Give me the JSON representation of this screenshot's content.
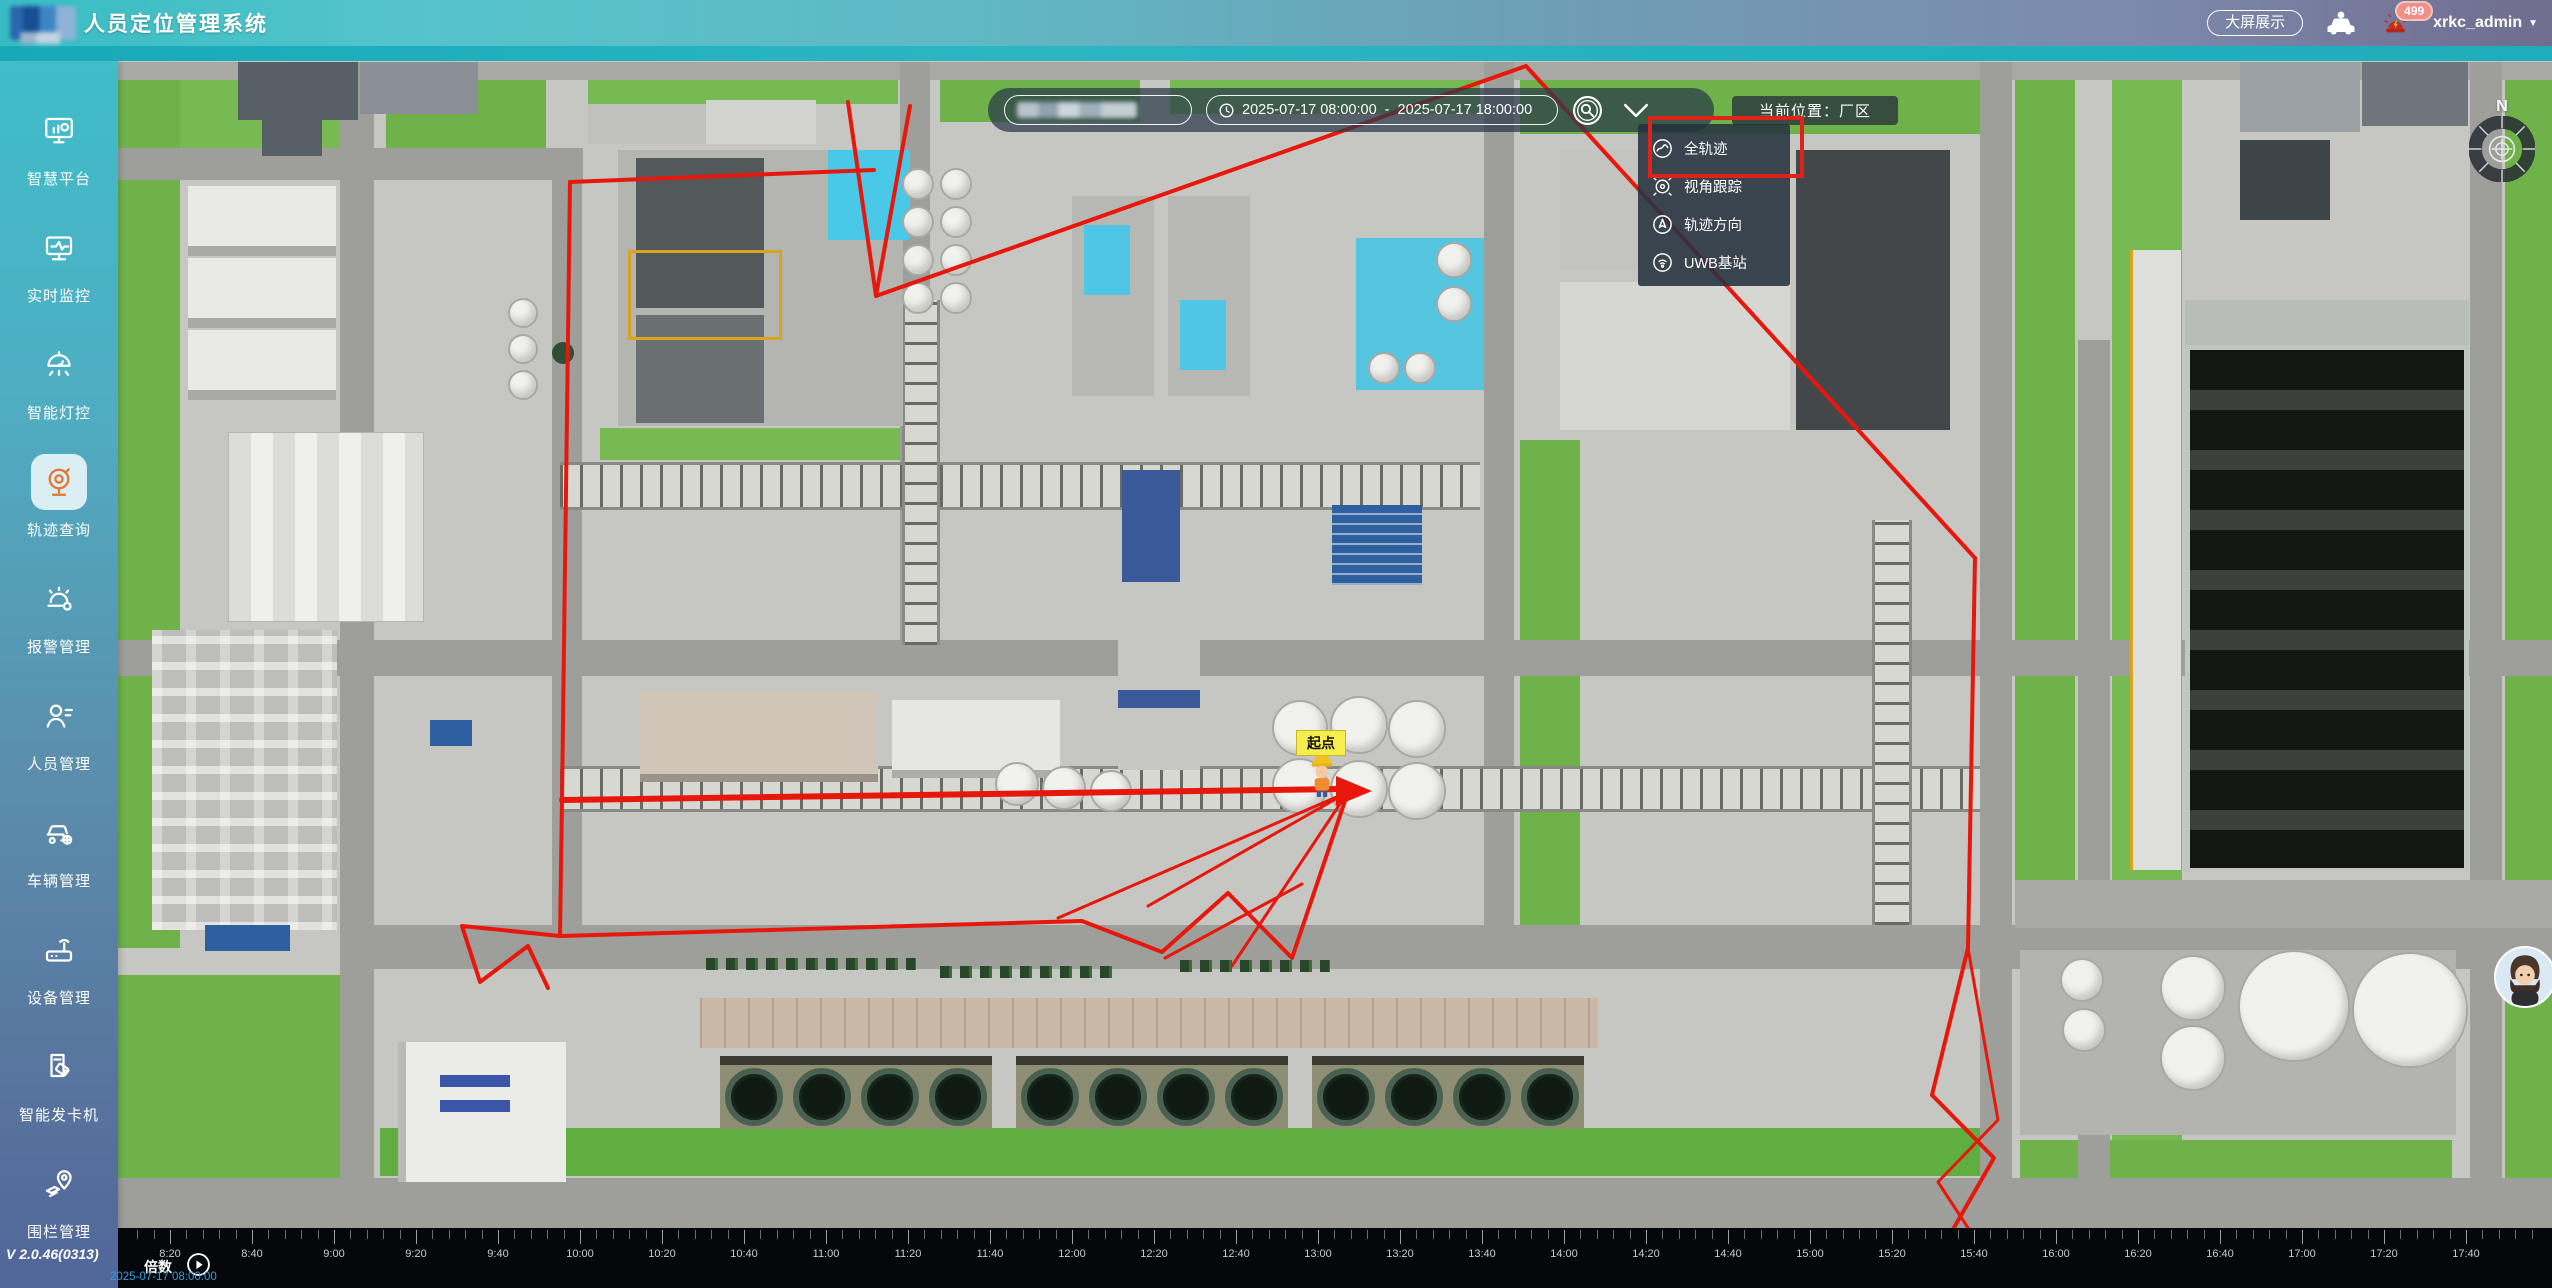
{
  "header": {
    "title": "人员定位管理系统",
    "big_screen": "大屏展示",
    "username": "xrkc_admin",
    "alarm_badge": "499"
  },
  "sidebar": {
    "version": "V 2.0.46(0313)",
    "items": [
      {
        "id": "smart-platform",
        "label": "智慧平台",
        "active": false
      },
      {
        "id": "realtime-monitor",
        "label": "实时监控",
        "active": false
      },
      {
        "id": "smart-light",
        "label": "智能灯控",
        "active": false
      },
      {
        "id": "track-query",
        "label": "轨迹查询",
        "active": true
      },
      {
        "id": "alarm-mgmt",
        "label": "报警管理",
        "active": false
      },
      {
        "id": "personnel-mgmt",
        "label": "人员管理",
        "active": false
      },
      {
        "id": "vehicle-mgmt",
        "label": "车辆管理",
        "active": false
      },
      {
        "id": "device-mgmt",
        "label": "设备管理",
        "active": false
      },
      {
        "id": "card-dispenser",
        "label": "智能发卡机",
        "active": false
      },
      {
        "id": "fence-mgmt",
        "label": "围栏管理",
        "active": false
      }
    ]
  },
  "toolbar": {
    "date_start": "2025-07-17 08:00:00",
    "separator": "-",
    "date_end": "2025-07-17 18:00:00",
    "location": "当前位置：厂区"
  },
  "dropdown": {
    "items": [
      {
        "id": "full-track",
        "label": "全轨迹",
        "highlighted": true
      },
      {
        "id": "view-follow",
        "label": "视角跟踪",
        "highlighted": false
      },
      {
        "id": "track-direction",
        "label": "轨迹方向",
        "highlighted": false
      },
      {
        "id": "uwb-station",
        "label": "UWB基站",
        "highlighted": false
      }
    ]
  },
  "map": {
    "start_marker": "起点",
    "compass_n": "N"
  },
  "timeline": {
    "speed_label": "倍数",
    "current_time": "2025-07-17 08:00:00",
    "start_x": 52,
    "spacing": 82,
    "labels": [
      "8:20",
      "8:40",
      "9:00",
      "9:20",
      "9:40",
      "10:00",
      "10:20",
      "10:40",
      "11:00",
      "11:20",
      "11:40",
      "12:00",
      "12:20",
      "12:40",
      "13:00",
      "13:20",
      "13:40",
      "14:00",
      "14:20",
      "14:40",
      "15:00",
      "15:20",
      "15:40",
      "16:00",
      "16:20",
      "16:40",
      "17:00",
      "17:20",
      "17:40"
    ]
  },
  "trajectory": {
    "color": "#e8170c",
    "arrow": [
      [
        1336,
        776
      ],
      [
        1372,
        791
      ],
      [
        1336,
        806
      ]
    ],
    "polylines": [
      {
        "w": 4,
        "points": [
          [
            848,
            102
          ],
          [
            876,
            296
          ],
          [
            910,
            106
          ]
        ]
      },
      {
        "w": 4,
        "points": [
          [
            876,
            296
          ],
          [
            1526,
            66
          ]
        ]
      },
      {
        "w": 4,
        "points": [
          [
            570,
            182
          ],
          [
            874,
            170
          ]
        ]
      },
      {
        "w": 4,
        "points": [
          [
            570,
            182
          ],
          [
            562,
            800
          ],
          [
            560,
            936
          ]
        ]
      },
      {
        "w": 6,
        "points": [
          [
            562,
            800
          ],
          [
            1340,
            789
          ]
        ]
      },
      {
        "w": 4,
        "points": [
          [
            560,
            936
          ],
          [
            1082,
            921
          ],
          [
            1162,
            952
          ],
          [
            1228,
            893
          ],
          [
            1292,
            958
          ],
          [
            1348,
            792
          ]
        ]
      },
      {
        "w": 3,
        "points": [
          [
            1348,
            792
          ],
          [
            1148,
            906
          ]
        ]
      },
      {
        "w": 3,
        "points": [
          [
            1348,
            792
          ],
          [
            1232,
            966
          ]
        ]
      },
      {
        "w": 3,
        "points": [
          [
            1348,
            792
          ],
          [
            1058,
            918
          ]
        ]
      },
      {
        "w": 3,
        "points": [
          [
            1165,
            958
          ],
          [
            1302,
            884
          ]
        ]
      },
      {
        "w": 4,
        "points": [
          [
            1526,
            66
          ],
          [
            1975,
            558
          ]
        ]
      },
      {
        "w": 4,
        "points": [
          [
            1975,
            558
          ],
          [
            1968,
            948
          ],
          [
            1932,
            1095
          ],
          [
            1994,
            1158
          ],
          [
            1948,
            1238
          ]
        ]
      },
      {
        "w": 3,
        "points": [
          [
            1968,
            948
          ],
          [
            1998,
            1120
          ],
          [
            1938,
            1182
          ],
          [
            1976,
            1240
          ]
        ]
      },
      {
        "w": 4,
        "points": [
          [
            560,
            936
          ],
          [
            462,
            926
          ],
          [
            480,
            982
          ],
          [
            528,
            946
          ],
          [
            548,
            988
          ]
        ]
      }
    ]
  },
  "colors": {
    "trajectory_red": "#e8170c",
    "annotation_red": "#e0231a",
    "active_icon_orange": "#e0782f",
    "start_label_yellow": "#f5ee4e",
    "timeline_time_blue": "#2f9fe0",
    "header_teal": "#38bcc4",
    "header_purple": "#6f6d90"
  }
}
